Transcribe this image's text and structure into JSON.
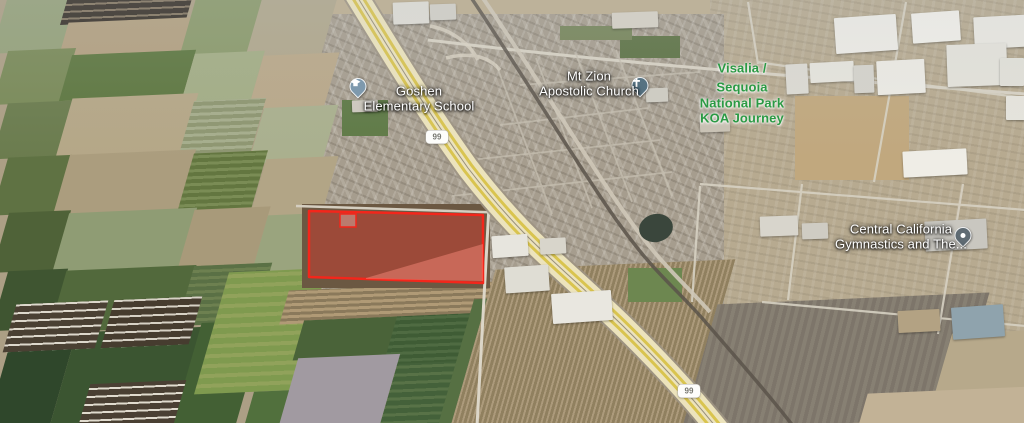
{
  "map": {
    "view": "satellite-aerial-3d",
    "markers": [
      {
        "id": "goshen-elementary-school",
        "lines": [
          "Goshen",
          "Elementary School"
        ],
        "category": "school",
        "text_color": "#ffffff",
        "pin_color": "#7e99ad"
      },
      {
        "id": "mt-zion-apostolic-church",
        "lines": [
          "Mt Zion",
          "Apostolic Church"
        ],
        "category": "church",
        "text_color": "#ffffff",
        "pin_color": "#567282"
      },
      {
        "id": "visalia-sequoia-national-park-koa-journey",
        "lines": [
          "Visalia /",
          "Sequoia",
          "National Park",
          "KOA Journey"
        ],
        "category": "campground",
        "text_color": "#2b9a44"
      },
      {
        "id": "central-california-gymnastics",
        "lines": [
          "Central California",
          "Gymnastics and The..."
        ],
        "category": "business",
        "text_color": "#ffffff",
        "pin_color": "#5f6b73"
      }
    ],
    "route_shields": [
      {
        "route": "99"
      },
      {
        "route": "99"
      }
    ],
    "highlight_parcel": {
      "stroke": "#f3261b",
      "fill": "#e0382e",
      "fill_opacity": "0.42"
    }
  }
}
